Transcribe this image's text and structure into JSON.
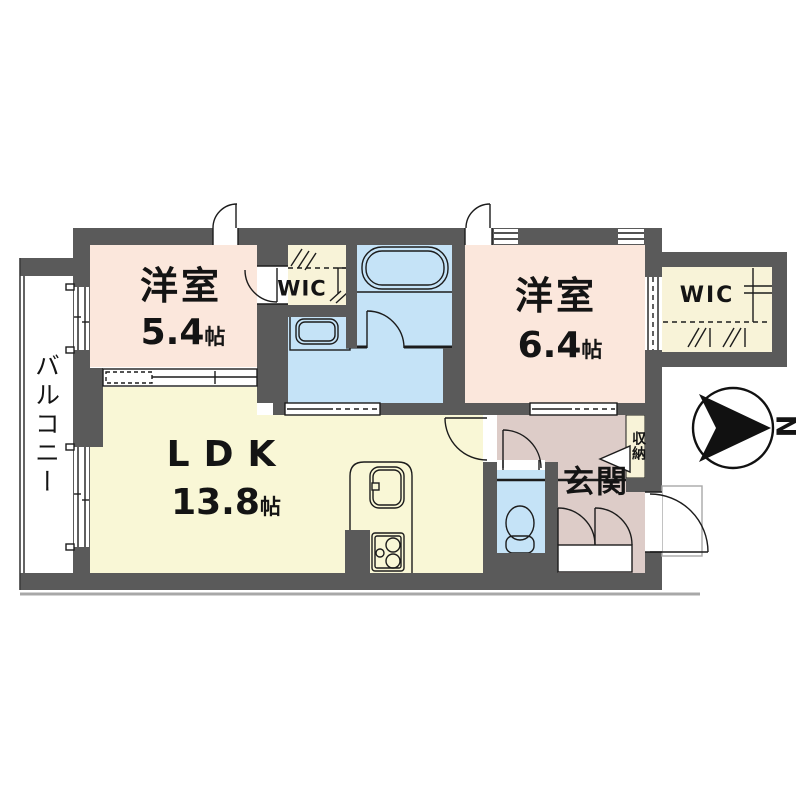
{
  "title": "apartment-floor-plan",
  "colors": {
    "wall": "#5a5a5a",
    "bedroom": "#fbe7dc",
    "living": "#f9f7d6",
    "closet": "#f8f3d8",
    "water": "#c5e3f7",
    "entrance": "#ddccc8",
    "white": "#ffffff"
  },
  "rooms": {
    "bedroom1": {
      "name": "洋室",
      "area_value": "5.4",
      "area_unit": "帖"
    },
    "bedroom2": {
      "name": "洋室",
      "area_value": "6.4",
      "area_unit": "帖"
    },
    "ldk": {
      "name": "LDK",
      "area_value": "13.8",
      "area_unit": "帖"
    },
    "wic_center": {
      "label": "WIC"
    },
    "wic_right": {
      "label": "WIC"
    },
    "balcony": {
      "label": "バルコニー"
    },
    "entrance": {
      "label": "玄関"
    },
    "storage": {
      "label": "収納"
    }
  },
  "compass": {
    "north_label": "N"
  }
}
